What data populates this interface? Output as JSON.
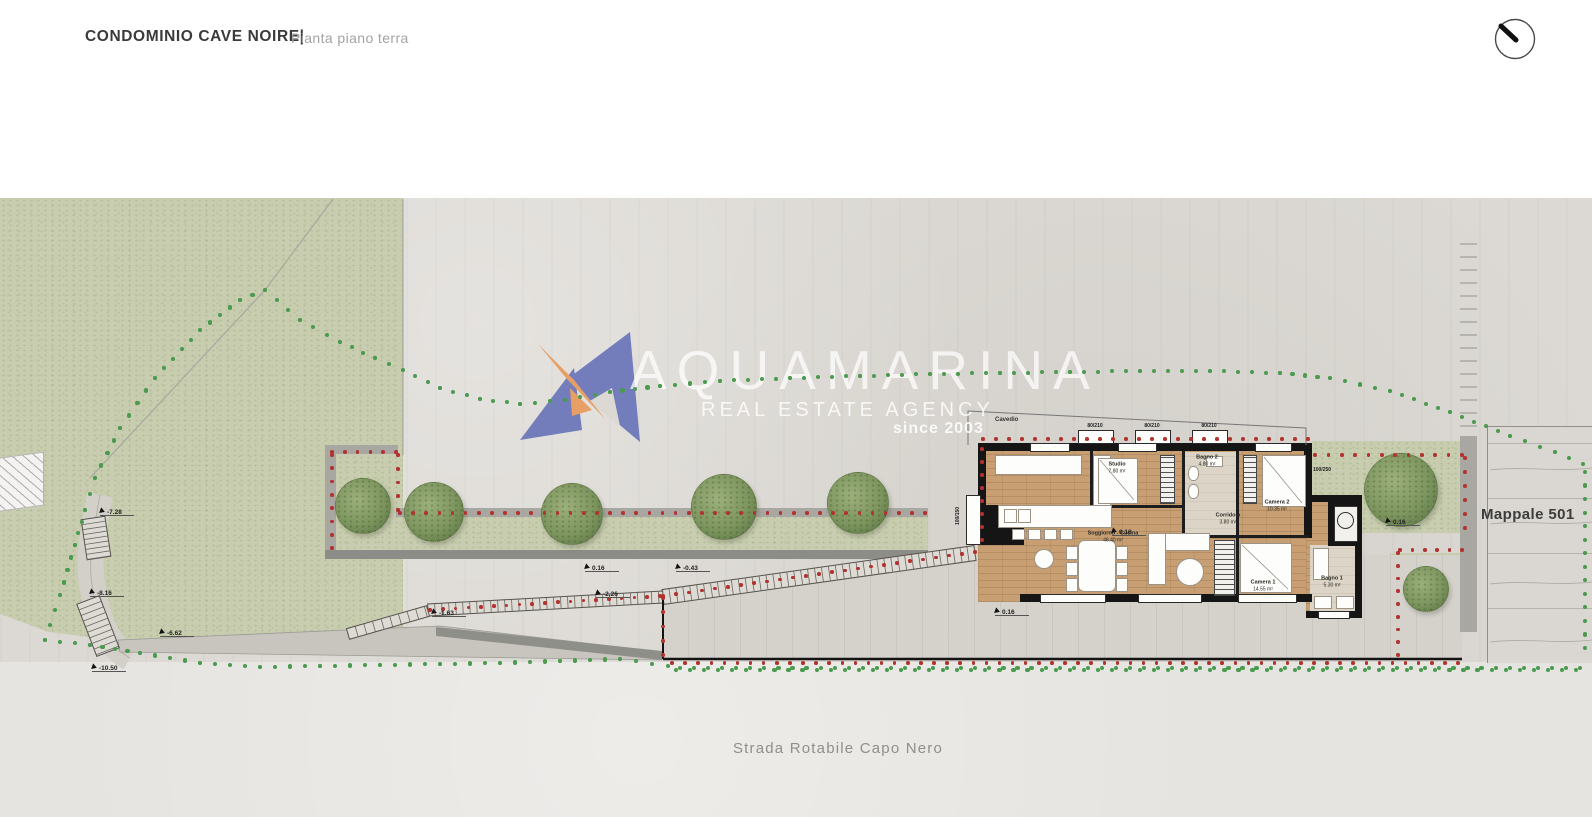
{
  "header": {
    "project_title": "CONDOMINIO CAVE NOIRE|",
    "drawing_subtitle": "Pianta piano terra"
  },
  "watermark": {
    "brand": "AQUAMARINA",
    "tagline": "REAL ESTATE AGENCY",
    "since": "since 2003"
  },
  "site_labels": {
    "parcel": "Mappale 501",
    "road": "Strada Rotabile Capo Nero",
    "shaft": "Cavedio"
  },
  "rooms": [
    {
      "name": "Soggiorno - Cucina",
      "area": "46.40 m²",
      "x": 1113,
      "y": 537
    },
    {
      "name": "Studio",
      "area": "7.80 m²",
      "x": 1117,
      "y": 468
    },
    {
      "name": "Bagno 2",
      "area": "4.80 m²",
      "x": 1207,
      "y": 461
    },
    {
      "name": "Corridoio",
      "area": "3.80 m²",
      "x": 1228,
      "y": 519
    },
    {
      "name": "Camera 2",
      "area": "10.35 m²",
      "x": 1277,
      "y": 506
    },
    {
      "name": "Camera 1",
      "area": "14.55 m²",
      "x": 1263,
      "y": 586
    },
    {
      "name": "Bagno 1",
      "area": "5.30 m²",
      "x": 1332,
      "y": 582
    }
  ],
  "elevation_markers": [
    {
      "value": "-7.28",
      "x": 100,
      "y": 508
    },
    {
      "value": "-8.16",
      "x": 90,
      "y": 589
    },
    {
      "value": "-6.62",
      "x": 160,
      "y": 629
    },
    {
      "value": "-10.50",
      "x": 92,
      "y": 664
    },
    {
      "value": "-1.63",
      "x": 432,
      "y": 609
    },
    {
      "value": "-2.26",
      "x": 596,
      "y": 590
    },
    {
      "value": "0.16",
      "x": 585,
      "y": 564
    },
    {
      "value": "-0.43",
      "x": 676,
      "y": 564
    },
    {
      "value": "0.16",
      "x": 995,
      "y": 608
    },
    {
      "value": "0.16",
      "x": 1112,
      "y": 528
    },
    {
      "value": "0.16",
      "x": 1386,
      "y": 518
    }
  ],
  "window_tags": [
    {
      "text": "100/150",
      "x": 958,
      "y": 516,
      "rot": -90
    },
    {
      "text": "100/250",
      "x": 1322,
      "y": 470,
      "rot": 0
    },
    {
      "text": "80/210",
      "x": 1095,
      "y": 426,
      "rot": 0
    },
    {
      "text": "80/210",
      "x": 1152,
      "y": 426,
      "rot": 0
    },
    {
      "text": "80/210",
      "x": 1209,
      "y": 426,
      "rot": 0
    }
  ],
  "icons": {
    "compass": "compass-pen-icon"
  },
  "colors": {
    "green_dot": "#4a9a4f",
    "red_dot": "#b23230",
    "logo_blue": "#6b75b9",
    "logo_orange": "#e89a5c",
    "grass": "#c7cdae",
    "plaza": "#dcd9d4",
    "road": "#e6e4e0",
    "wood_floor": "#c79f72",
    "wall_black": "#151515",
    "title_text": "#3a3a3a",
    "subtitle_text": "#a3a3a3",
    "road_text": "#8f9089"
  }
}
